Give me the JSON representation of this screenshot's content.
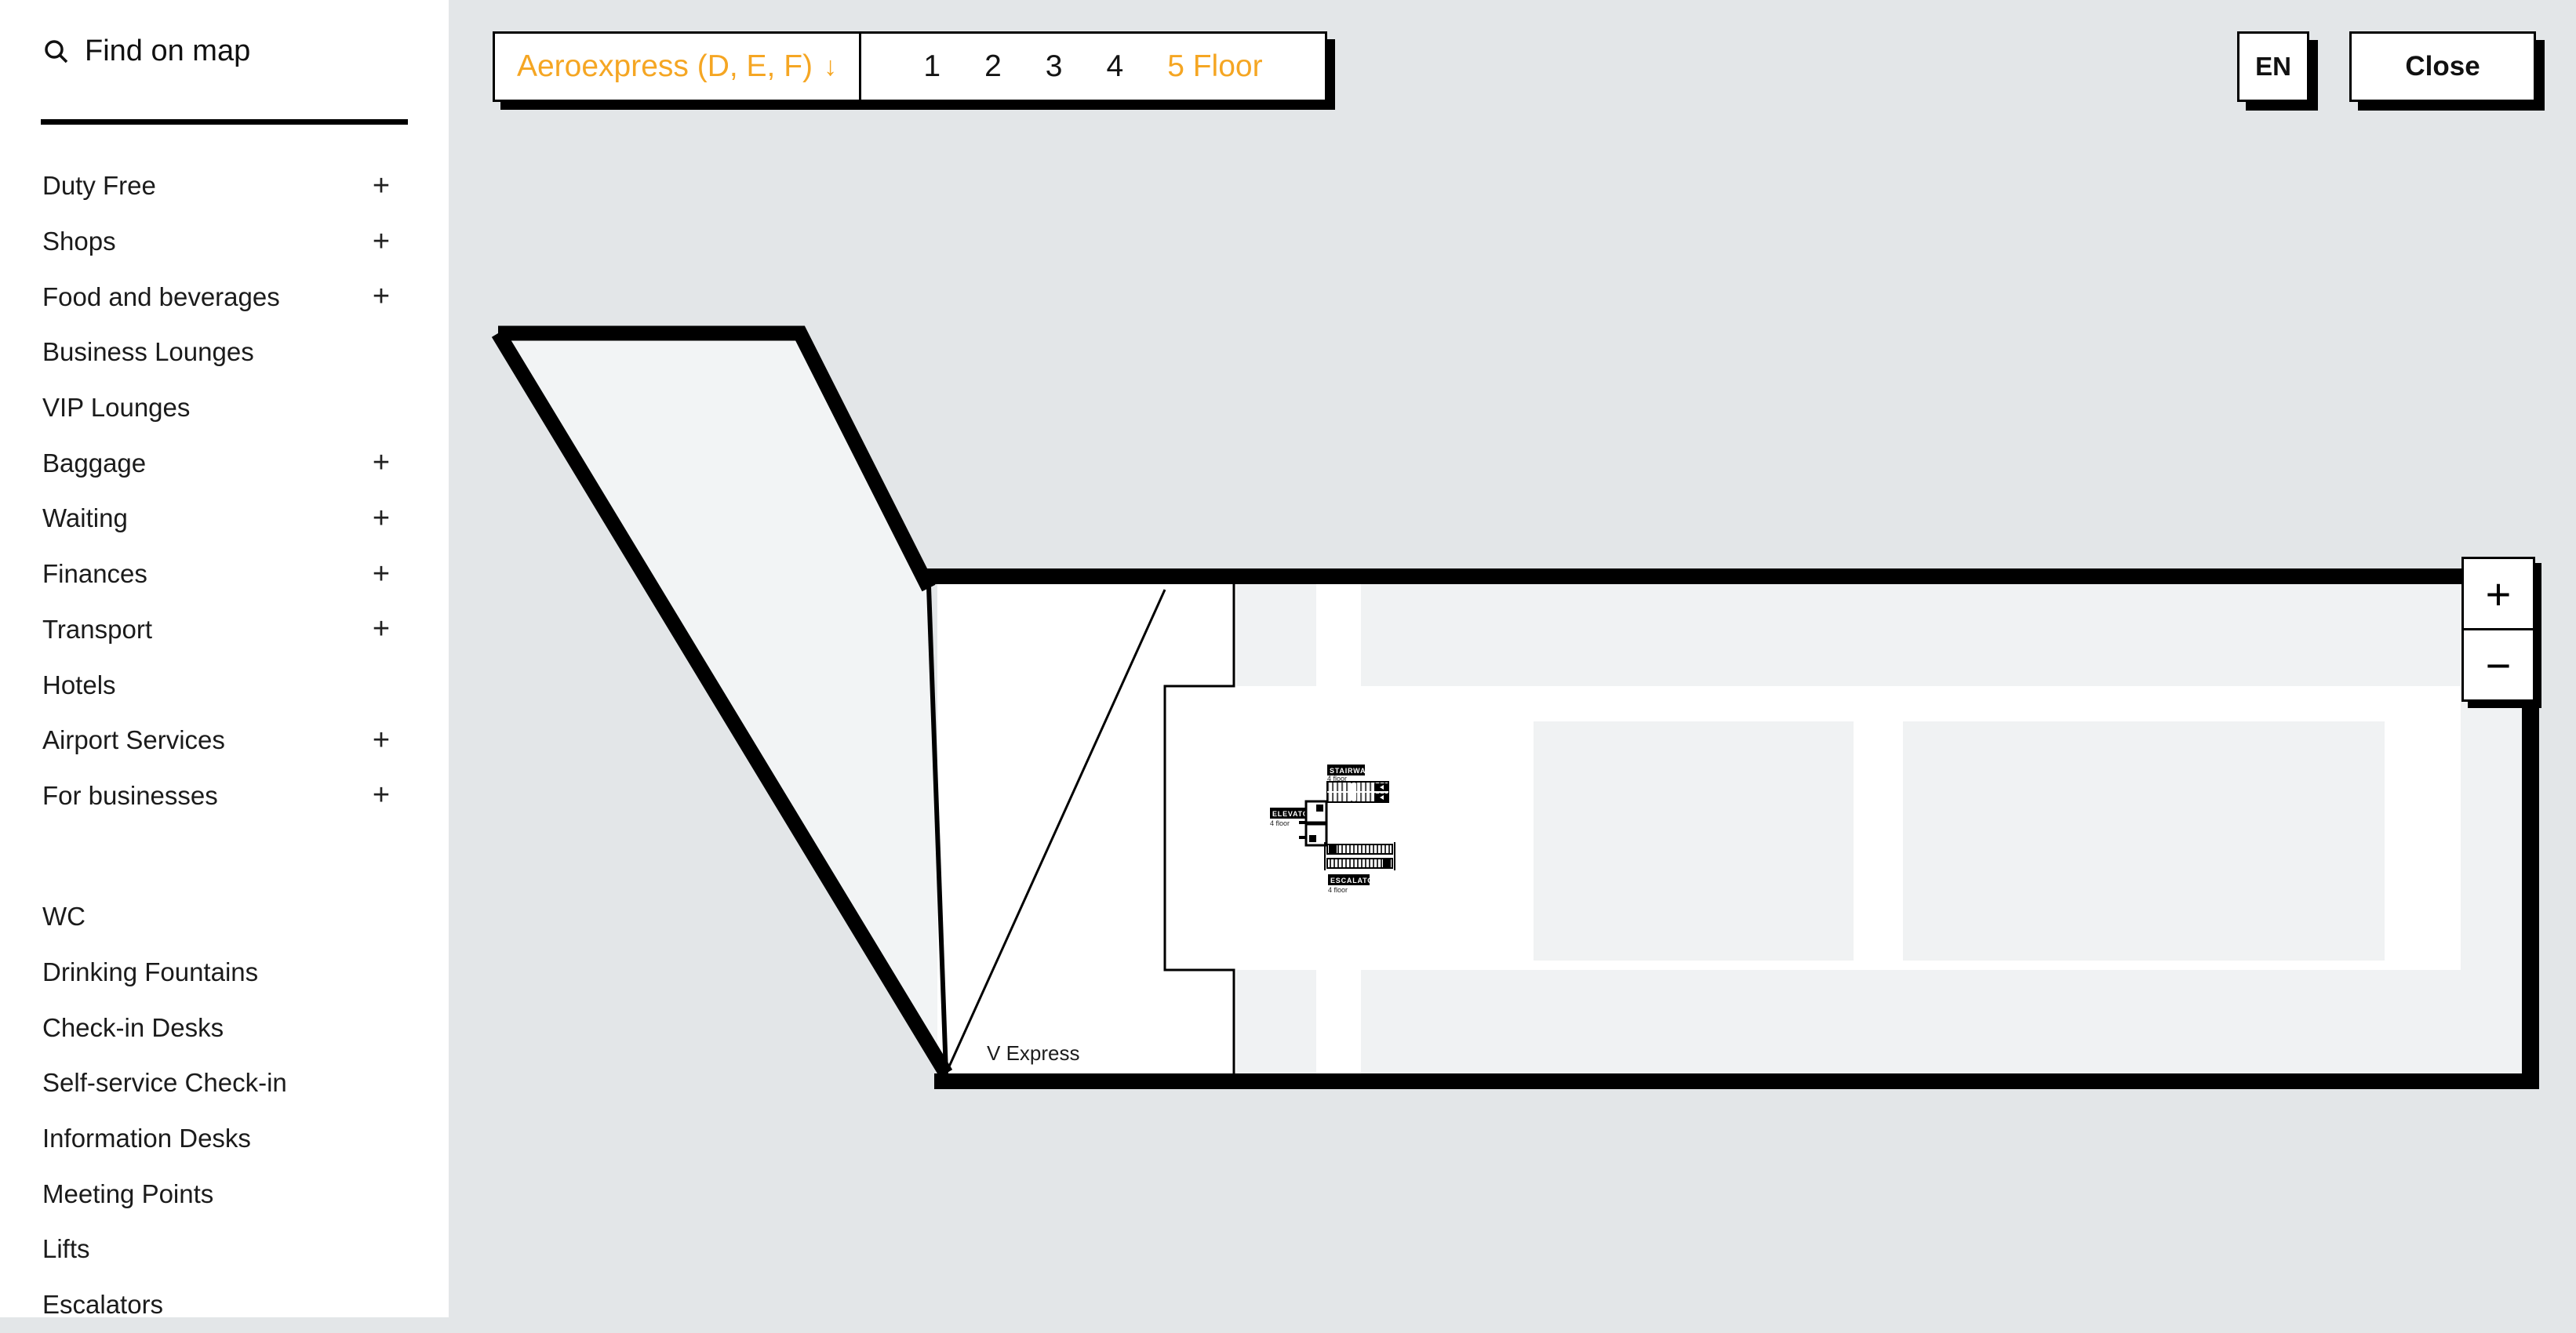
{
  "colors": {
    "accent": "#F5A623",
    "page_bg": "#E3E6E8",
    "zone": "#F0F2F3",
    "wing": "#F2F4F5",
    "line": "#000000"
  },
  "sidebar": {
    "search_label": "Find on map",
    "items": [
      {
        "label": "Duty Free",
        "plus": "+"
      },
      {
        "label": "Shops",
        "plus": "+"
      },
      {
        "label": "Food and beverages",
        "plus": "+"
      },
      {
        "label": "Business Lounges"
      },
      {
        "label": "VIP Lounges"
      },
      {
        "label": "Baggage",
        "plus": "+"
      },
      {
        "label": "Waiting",
        "plus": "+"
      },
      {
        "label": "Finances",
        "plus": "+"
      },
      {
        "label": "Transport",
        "plus": "+"
      },
      {
        "label": "Hotels"
      },
      {
        "label": "Airport Services",
        "plus": "+"
      },
      {
        "label": "For businesses",
        "plus": "+"
      }
    ],
    "items2": [
      {
        "label": "WC"
      },
      {
        "label": "Drinking Fountains"
      },
      {
        "label": "Check-in Desks"
      },
      {
        "label": "Self-service Check-in"
      },
      {
        "label": "Information Desks"
      },
      {
        "label": "Meeting Points"
      },
      {
        "label": "Lifts"
      },
      {
        "label": "Escalators"
      }
    ]
  },
  "topbar": {
    "terminal": {
      "label": "Aeroexpress (D, E, F)",
      "arrow": "↓"
    },
    "floors": {
      "f1": "1",
      "f2": "2",
      "f3": "3",
      "f4": "4",
      "active": "5 Floor"
    },
    "lang": "EN",
    "close": "Close"
  },
  "map": {
    "stairway": {
      "title": "STAIRWAY",
      "sub": "4 floor"
    },
    "elevator": {
      "title": "ELEVATOR",
      "sub": "4 floor"
    },
    "escalator": {
      "title": "ESCALATOR",
      "sub": "4 floor"
    },
    "v_express": "V Express"
  },
  "zoom": {
    "plus": "+",
    "minus": "−"
  }
}
